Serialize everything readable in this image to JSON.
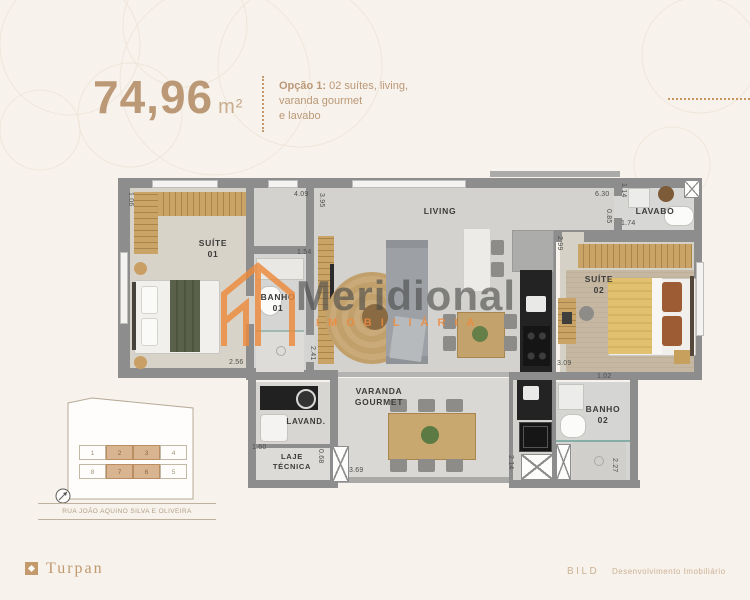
{
  "header": {
    "area_value": "74,96",
    "area_unit": "m²",
    "option_title": "Opção 1:",
    "option_rest": "02 suítes, living,",
    "option_line2": "varanda gourmet",
    "option_line3": "e lavabo"
  },
  "watermark": {
    "name": "Meridional",
    "subtitle": "IMOBILIÁRIA"
  },
  "plan": {
    "labels": {
      "suite01_1": "SUÍTE",
      "suite01_2": "01",
      "banho01_1": "BANHO",
      "banho01_2": "01",
      "living": "LIVING",
      "lavabo": "LAVABO",
      "suite02_1": "SUÍTE",
      "suite02_2": "02",
      "lavand": "LAVAND.",
      "laje_1": "LAJE",
      "laje_2": "TÉCNICA",
      "varanda_1": "VARANDA",
      "varanda_2": "GOURMET",
      "banho02_1": "BANHO",
      "banho02_2": "02"
    },
    "dims": {
      "d1": "4.09",
      "d2": "3.95",
      "d3": "1.06",
      "d4": "2.56",
      "d5": "1.54",
      "d6": "2.41",
      "d7": "2.99",
      "d8": "6.30",
      "d9": "1.14",
      "d10": "0.85",
      "d11": "1.74",
      "d12": "3.09",
      "d13": "1.02",
      "d14": "1.60",
      "d15": "0.68",
      "d16": "3.69",
      "d17": "2.14",
      "d18": "2.27"
    }
  },
  "keyplan": {
    "street": "RUA JOÃO AQUINO SILVA E OLIVEIRA",
    "units": [
      {
        "n": "1",
        "hl": false
      },
      {
        "n": "2",
        "hl": true
      },
      {
        "n": "3",
        "hl": true
      },
      {
        "n": "4",
        "hl": false
      },
      {
        "n": "8",
        "hl": false
      },
      {
        "n": "7",
        "hl": true
      },
      {
        "n": "6",
        "hl": true
      },
      {
        "n": "5",
        "hl": false
      }
    ]
  },
  "footer": {
    "brand_left": "Turpan",
    "brand_right": "BILD",
    "brand_right_text": "Desenvolvimento Imobiliário"
  },
  "colors": {
    "accent_tan": "#bb9876",
    "logo_orange": "#ed8a3c",
    "wall_gray": "#8d8d8d",
    "highlight_unit": "#d9b490"
  }
}
